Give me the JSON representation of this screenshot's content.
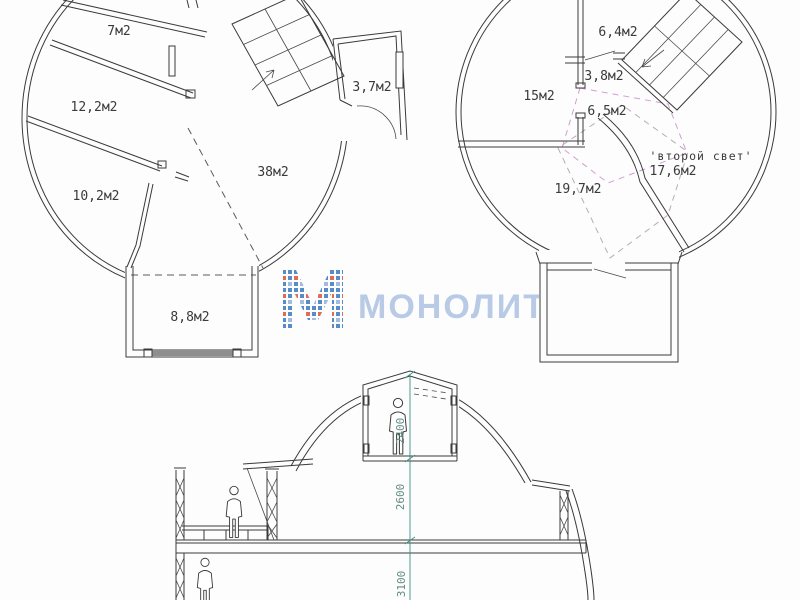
{
  "floor1": {
    "room_top": "7м2",
    "room_mid": "12,2м2",
    "room_lower": "10,2м2",
    "room_main": "38м2",
    "room_balcony": "3,7м2",
    "room_bottom": "8,8м2"
  },
  "floor2": {
    "room_top": "6,4м2",
    "room_small": "3,8м2",
    "room_left": "15м2",
    "room_pink": "6,5м2",
    "room_bottom_left": "19,7м2",
    "room_right": "17,6м2",
    "second_light_note": "'второй свет'"
  },
  "section": {
    "dim_top": "2400",
    "dim_mid": "2600",
    "dim_bottom": "3100"
  },
  "watermark": {
    "brand": "МОНОЛИТ"
  },
  "colors": {
    "accent_pink": "#c257c2",
    "pink_dash": "#d49cd4",
    "gray_dash": "#bba9bb",
    "dim_teal": "#3e8e82",
    "dim_text": "#5f8a82",
    "watermark_blue": "#b5c8e4",
    "logo_blue": "#4e86c6",
    "logo_orange": "#e0654d",
    "line": "#3a3a3a"
  }
}
